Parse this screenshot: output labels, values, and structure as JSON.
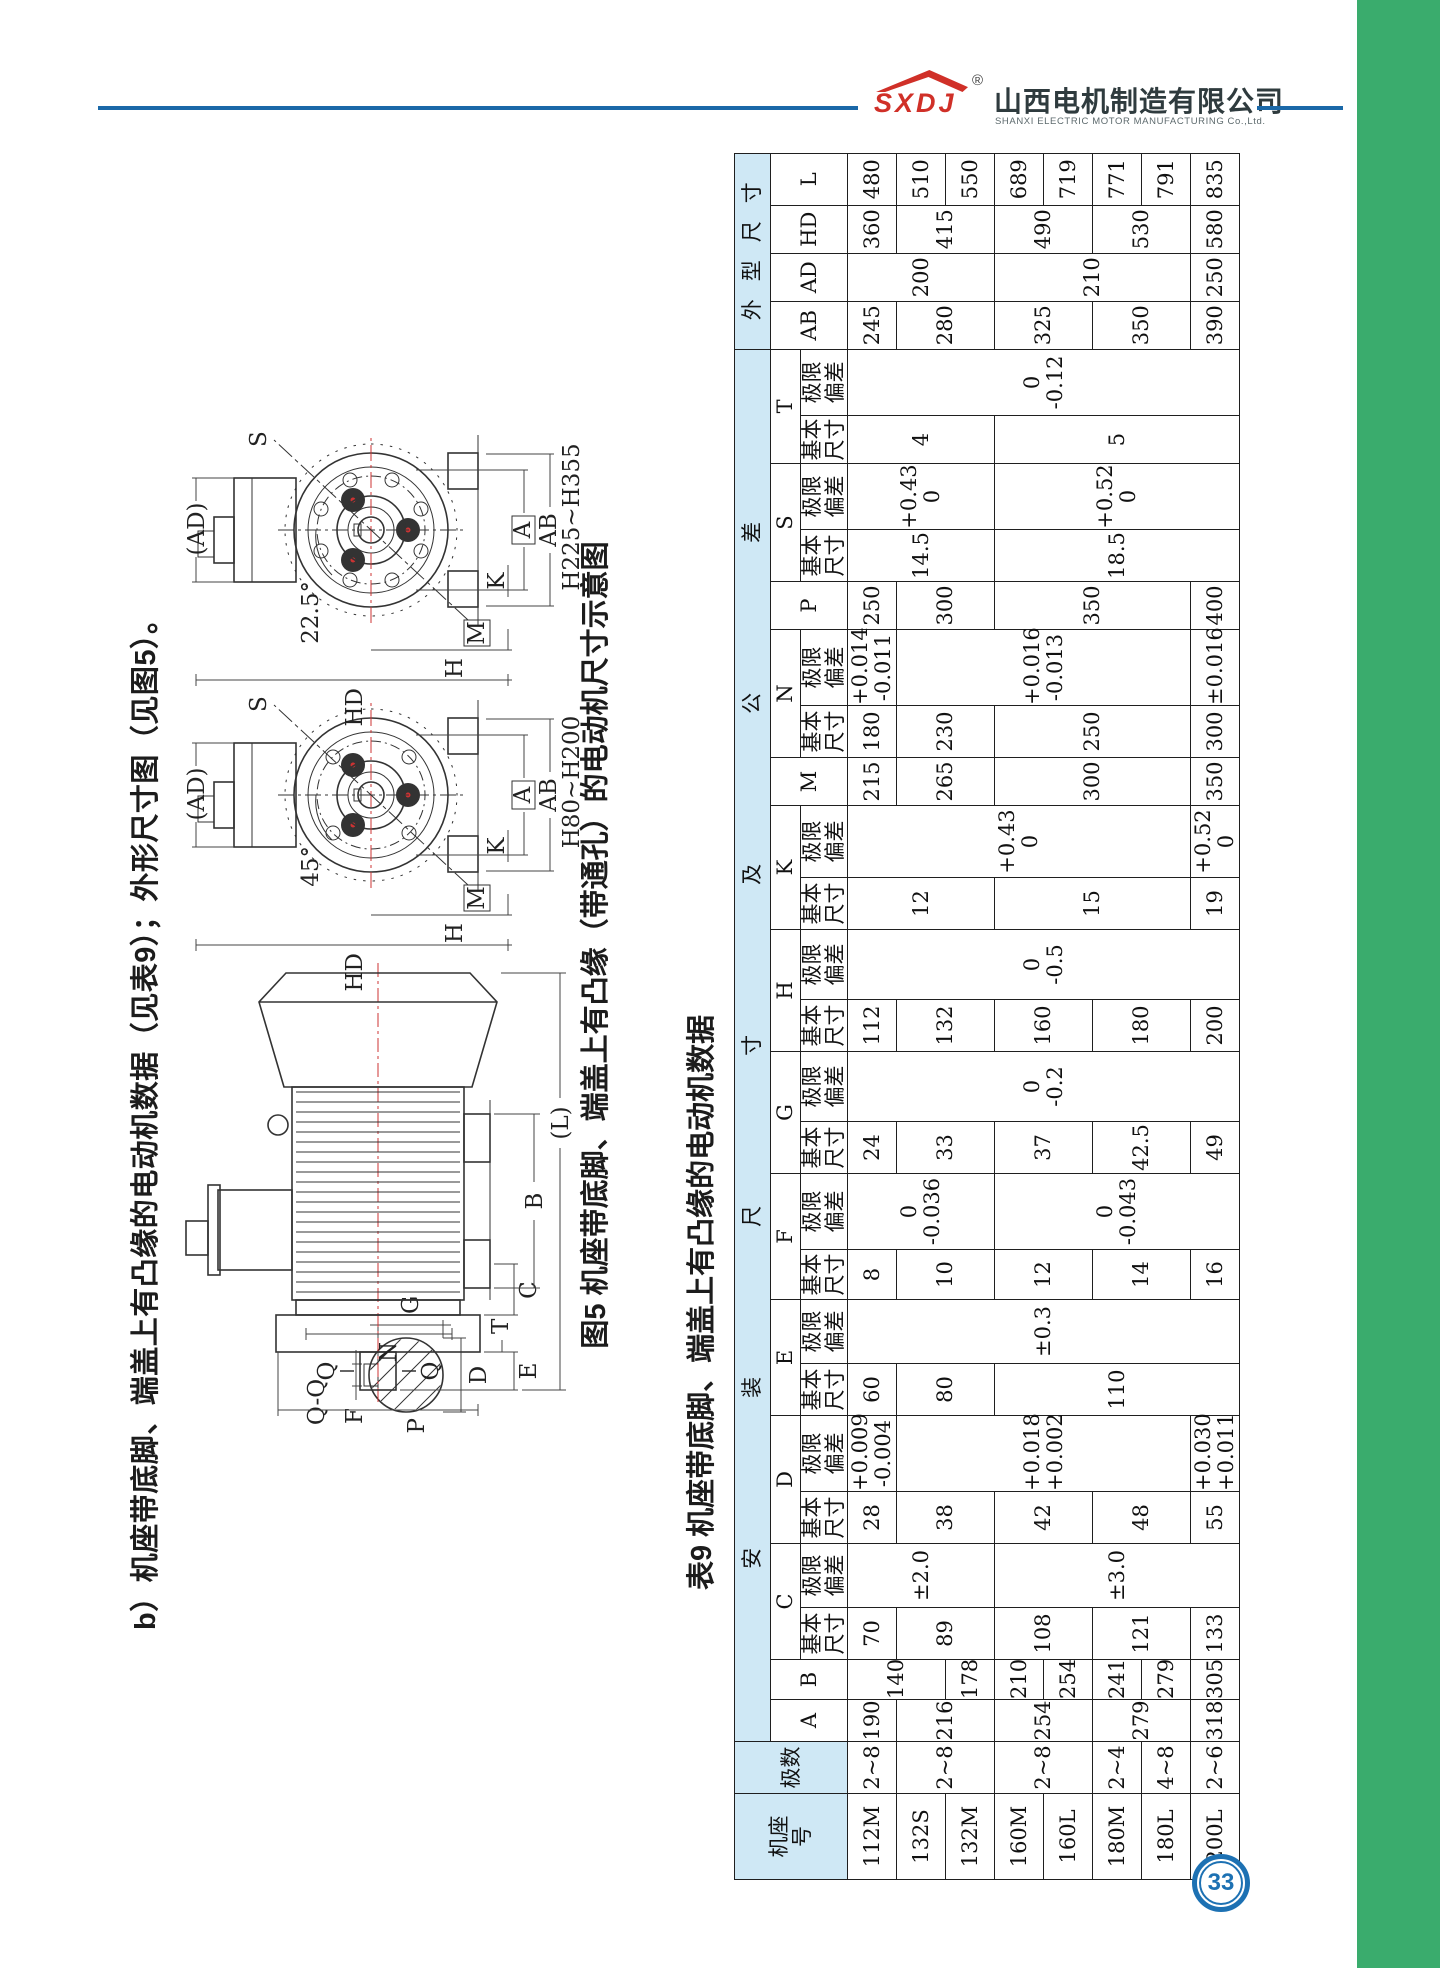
{
  "header": {
    "logo": "SXDJ",
    "registered": "®",
    "company_zh": "山西电机制造有限公司",
    "company_en": "SHANXI ELECTRIC MOTOR MANUFACTURING Co.,Ltd."
  },
  "page": {
    "number": "33"
  },
  "section_heading": "b）机座带底脚、端盖上有凸缘的电动机数据（见表9）；外形尺寸图（见图5）。",
  "figure": {
    "caption": "图5 机座带底脚、端盖上有凸缘（带通孔）的电动机尺寸示意图",
    "labels": {
      "qq_title": "Q-Q",
      "f": "F",
      "g": "G",
      "d": "D",
      "q": "Q",
      "n": "N",
      "p": "P",
      "e": "E",
      "t": "T",
      "c": "C",
      "b": "B",
      "l": "(L)",
      "ad": "(AD)",
      "s": "S",
      "m": "M",
      "k": "K",
      "a": "A",
      "ab": "AB",
      "h": "H",
      "hd": "HD",
      "angle_small": "45°",
      "angle_large": "22.5°",
      "range_small": "H80~H200",
      "range_large": "H225~H355"
    }
  },
  "table": {
    "title": "表9 机座带底脚、端盖上有凸缘的电动机数据",
    "col_widths": [
      86,
      52,
      42,
      40,
      52,
      64,
      52,
      76,
      52,
      64,
      50,
      76,
      52,
      70,
      52,
      70,
      52,
      72,
      48,
      52,
      76,
      48,
      52,
      66,
      48,
      66,
      48,
      48,
      48,
      52
    ],
    "header": [
      [
        {
          "t": "机座\n号",
          "rs": 3,
          "hl": 1
        },
        {
          "t": "极数",
          "rs": 3,
          "hl": 1
        },
        {
          "t": "安装尺寸及公差",
          "cs": 24,
          "hl": 1,
          "sp": "spread"
        },
        {
          "t": "外型尺寸",
          "cs": 4,
          "hl": 1,
          "sp": "spread2"
        }
      ],
      [
        {
          "t": "A",
          "rs": 2
        },
        {
          "t": "B",
          "rs": 2
        },
        {
          "t": "C",
          "cs": 2
        },
        {
          "t": "D",
          "cs": 2
        },
        {
          "t": "E",
          "cs": 2
        },
        {
          "t": "F",
          "cs": 2
        },
        {
          "t": "G",
          "cs": 2
        },
        {
          "t": "H",
          "cs": 2
        },
        {
          "t": "K",
          "cs": 2
        },
        {
          "t": "M",
          "rs": 2
        },
        {
          "t": "N",
          "cs": 2
        },
        {
          "t": "P",
          "rs": 2
        },
        {
          "t": "S",
          "cs": 2
        },
        {
          "t": "T",
          "cs": 2
        },
        {
          "t": "AB",
          "rs": 2
        },
        {
          "t": "AD",
          "rs": 2
        },
        {
          "t": "HD",
          "rs": 2
        },
        {
          "t": "L",
          "rs": 2
        }
      ],
      [
        {
          "t": "基本\n尺寸"
        },
        {
          "t": "极限\n偏差"
        },
        {
          "t": "基本\n尺寸"
        },
        {
          "t": "极限\n偏差"
        },
        {
          "t": "基本\n尺寸"
        },
        {
          "t": "极限\n偏差"
        },
        {
          "t": "基本\n尺寸"
        },
        {
          "t": "极限\n偏差"
        },
        {
          "t": "基本\n尺寸"
        },
        {
          "t": "极限\n偏差"
        },
        {
          "t": "基本\n尺寸"
        },
        {
          "t": "极限\n偏差"
        },
        {
          "t": "基本\n尺寸"
        },
        {
          "t": "极限\n偏差"
        },
        {
          "t": "基本\n尺寸"
        },
        {
          "t": "极限\n偏差"
        },
        {
          "t": "基本\n尺寸"
        },
        {
          "t": "极限\n偏差"
        },
        {
          "t": "基本\n尺寸"
        },
        {
          "t": "极限\n偏差"
        }
      ]
    ],
    "rows": [
      [
        {
          "t": "112M"
        },
        {
          "t": "2~8"
        },
        {
          "t": "190"
        },
        {
          "t": "140",
          "rs": 2
        },
        {
          "t": "70"
        },
        {
          "t": "±2.0",
          "rs": 3
        },
        {
          "t": "28"
        },
        {
          "t": "+0.009\n-0.004"
        },
        {
          "t": "60"
        },
        {
          "t": "±0.3",
          "rs": 8
        },
        {
          "t": "8"
        },
        {
          "t": "0\n-0.036",
          "rs": 3
        },
        {
          "t": "24"
        },
        {
          "t": "0\n-0.2",
          "rs": 8
        },
        {
          "t": "112"
        },
        {
          "t": "0\n-0.5",
          "rs": 8
        },
        {
          "t": "12",
          "rs": 3
        },
        {
          "t": "+0.43\n0",
          "rs": 7
        },
        {
          "t": "215"
        },
        {
          "t": "180"
        },
        {
          "t": "+0.014\n-0.011"
        },
        {
          "t": "250"
        },
        {
          "t": "14.5",
          "rs": 3
        },
        {
          "t": "+0.43\n0",
          "rs": 3
        },
        {
          "t": "4",
          "rs": 3
        },
        {
          "t": "0\n-0.12",
          "rs": 8
        },
        {
          "t": "245"
        },
        {
          "t": "200",
          "rs": 3
        },
        {
          "t": "360"
        },
        {
          "t": "480"
        }
      ],
      [
        {
          "t": "132S"
        },
        {
          "t": "2~8",
          "rs": 2
        },
        {
          "t": "216",
          "rs": 2
        },
        {
          "t": "89",
          "rs": 2
        },
        {
          "t": "38",
          "rs": 2
        },
        {
          "t": "+0.018\n+0.002",
          "rs": 6
        },
        {
          "t": "80",
          "rs": 2
        },
        {
          "t": "10",
          "rs": 2
        },
        {
          "t": "33",
          "rs": 2
        },
        {
          "t": "132",
          "rs": 2
        },
        {
          "t": "265",
          "rs": 2
        },
        {
          "t": "230",
          "rs": 2
        },
        {
          "t": "+0.016\n-0.013",
          "rs": 6
        },
        {
          "t": "300",
          "rs": 2
        },
        {
          "t": "280",
          "rs": 2
        },
        {
          "t": "415",
          "rs": 2
        },
        {
          "t": "510"
        }
      ],
      [
        {
          "t": "132M"
        },
        {
          "t": "178"
        },
        {
          "t": "550"
        }
      ],
      [
        {
          "t": "160M"
        },
        {
          "t": "2~8",
          "rs": 2
        },
        {
          "t": "254",
          "rs": 2
        },
        {
          "t": "210"
        },
        {
          "t": "108",
          "rs": 2
        },
        {
          "t": "±3.0",
          "rs": 5
        },
        {
          "t": "42",
          "rs": 2
        },
        {
          "t": "110",
          "rs": 5
        },
        {
          "t": "12",
          "rs": 2
        },
        {
          "t": "0\n-0.043",
          "rs": 5
        },
        {
          "t": "37",
          "rs": 2
        },
        {
          "t": "160",
          "rs": 2
        },
        {
          "t": "15",
          "rs": 4
        },
        {
          "t": "300",
          "rs": 4
        },
        {
          "t": "250",
          "rs": 4
        },
        {
          "t": "350",
          "rs": 4
        },
        {
          "t": "18.5",
          "rs": 5
        },
        {
          "t": "+0.52\n0",
          "rs": 5
        },
        {
          "t": "5",
          "rs": 5
        },
        {
          "t": "325",
          "rs": 2
        },
        {
          "t": "210",
          "rs": 4
        },
        {
          "t": "490",
          "rs": 2
        },
        {
          "t": "689"
        }
      ],
      [
        {
          "t": "160L"
        },
        {
          "t": "254"
        },
        {
          "t": "719"
        }
      ],
      [
        {
          "t": "180M"
        },
        {
          "t": "2~4"
        },
        {
          "t": "279",
          "rs": 2
        },
        {
          "t": "241"
        },
        {
          "t": "121",
          "rs": 2
        },
        {
          "t": "48",
          "rs": 2
        },
        {
          "t": "14",
          "rs": 2
        },
        {
          "t": "42.5",
          "rs": 2
        },
        {
          "t": "180",
          "rs": 2
        },
        {
          "t": "350",
          "rs": 2
        },
        {
          "t": "530",
          "rs": 2
        },
        {
          "t": "771"
        }
      ],
      [
        {
          "t": "180L"
        },
        {
          "t": "4~8"
        },
        {
          "t": "279"
        },
        {
          "t": "791"
        }
      ],
      [
        {
          "t": "200L"
        },
        {
          "t": "2~6"
        },
        {
          "t": "318"
        },
        {
          "t": "305"
        },
        {
          "t": "133"
        },
        {
          "t": "55"
        },
        {
          "t": "+0.030\n+0.011"
        },
        {
          "t": "16"
        },
        {
          "t": "49"
        },
        {
          "t": "200"
        },
        {
          "t": "19"
        },
        {
          "t": "+0.52\n0"
        },
        {
          "t": "350"
        },
        {
          "t": "300"
        },
        {
          "t": "±0.016"
        },
        {
          "t": "400"
        },
        {
          "t": "390"
        },
        {
          "t": "250"
        },
        {
          "t": "580"
        },
        {
          "t": "835"
        }
      ]
    ]
  }
}
